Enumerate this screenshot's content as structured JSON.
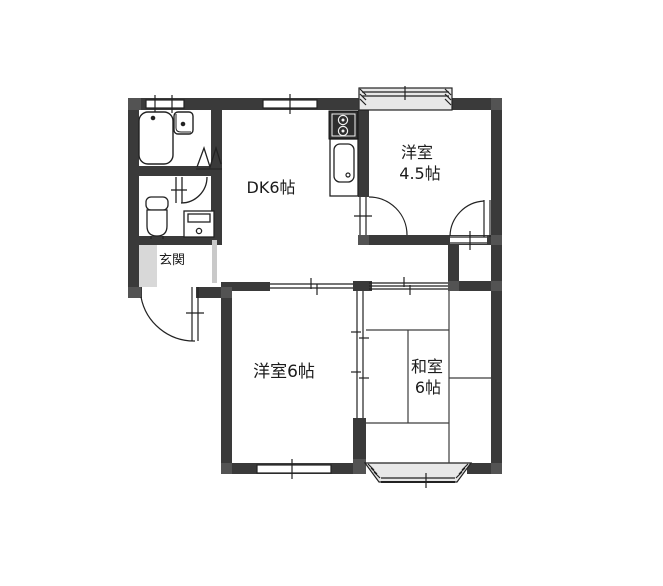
{
  "floorplan": {
    "type": "apartment-floor-plan",
    "labels": {
      "dk": "DK6帖",
      "western45_line1": "洋室",
      "western45_line2": "4.5帖",
      "western6": "洋室6帖",
      "japanese6_line1": "和室",
      "japanese6_line2": "6帖",
      "genkan": "玄関"
    },
    "rooms": [
      {
        "id": "dk",
        "label": "DK6帖"
      },
      {
        "id": "western-room-4-5",
        "label": "洋室 4.5帖"
      },
      {
        "id": "western-room-6",
        "label": "洋室6帖"
      },
      {
        "id": "japanese-room-6",
        "label": "和室 6帖"
      },
      {
        "id": "genkan",
        "label": "玄関"
      }
    ],
    "fixtures": [
      "bathtub",
      "washbasin",
      "toilet",
      "washing-machine-pan",
      "gas-stove",
      "kitchen-sink"
    ],
    "features": [
      "entrance-door",
      "toilet-door",
      "folding-door",
      "bath-window",
      "dk-window",
      "bay-window-north",
      "bay-window-south",
      "west-room-window",
      "oshiire-closet",
      "closet-4-5",
      "fusuma-sliding-doors",
      "room-divider-sliding-doors",
      "tatami-6-mat-grid"
    ],
    "colors": {
      "wall": "#3a3a3a",
      "pillar": "#535353",
      "line": "#222222",
      "bay_fill": "#e8e8e8",
      "genkan_floor": "#d8d8d8",
      "background": "#ffffff"
    }
  }
}
